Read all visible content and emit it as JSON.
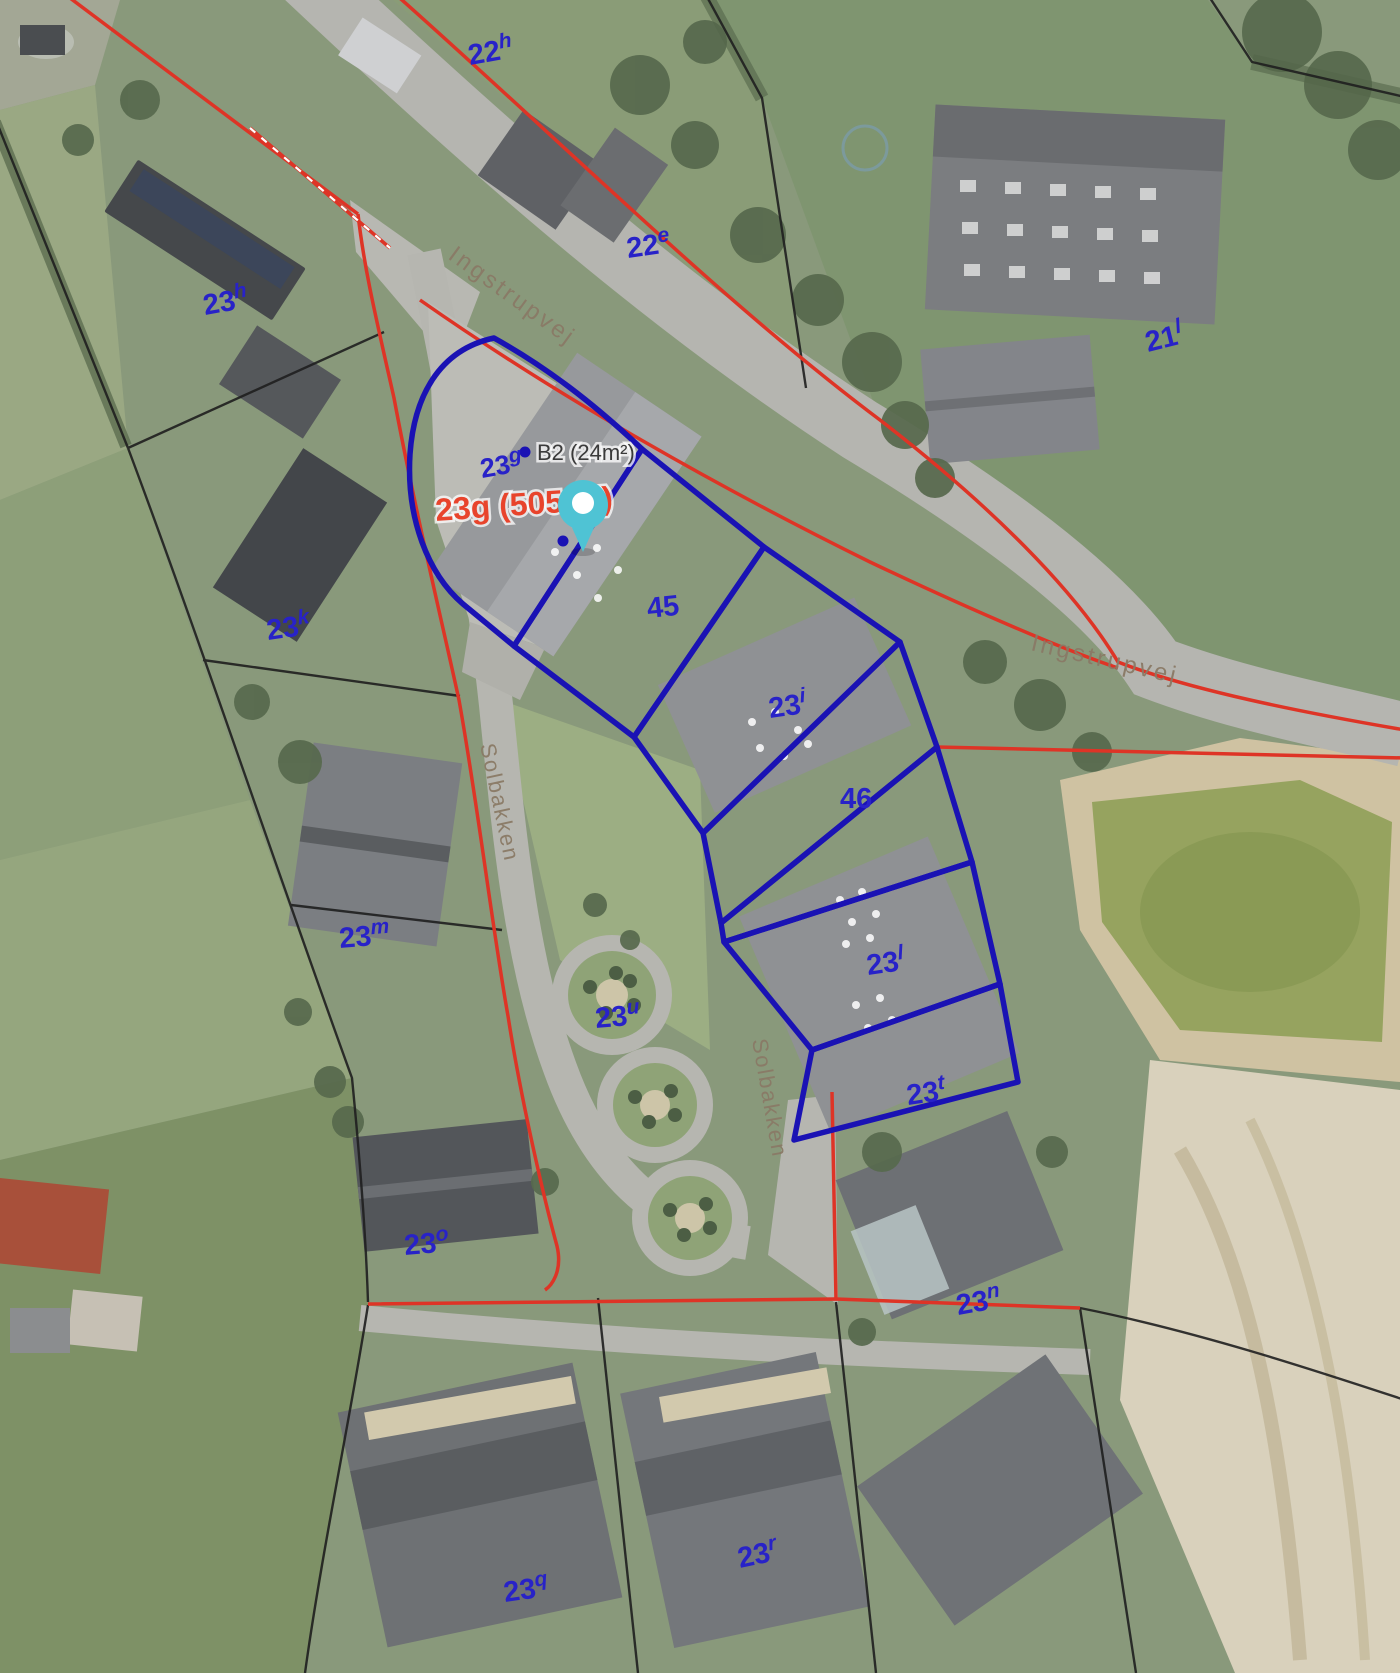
{
  "map": {
    "type": "cadastral-aerial-map",
    "parcel_labels": [
      {
        "base": "22",
        "sup": "h"
      },
      {
        "base": "22",
        "sup": "e"
      },
      {
        "base": "21",
        "sup": "l"
      },
      {
        "base": "23",
        "sup": "h"
      },
      {
        "base": "23",
        "sup": "g"
      },
      {
        "base": "23",
        "sup": "k"
      },
      {
        "base": "45",
        "sup": ""
      },
      {
        "base": "23",
        "sup": "i"
      },
      {
        "base": "46",
        "sup": ""
      },
      {
        "base": "23",
        "sup": "m"
      },
      {
        "base": "23",
        "sup": "u"
      },
      {
        "base": "23",
        "sup": "l"
      },
      {
        "base": "23",
        "sup": "t"
      },
      {
        "base": "23",
        "sup": "o"
      },
      {
        "base": "23",
        "sup": "n"
      },
      {
        "base": "23",
        "sup": "q"
      },
      {
        "base": "23",
        "sup": "r"
      }
    ],
    "road_labels": [
      {
        "text": "Ingstrupvej"
      },
      {
        "text": "Ingstrupvej"
      },
      {
        "text": "Solbakken"
      },
      {
        "text": "Solbakken"
      }
    ],
    "annotations": {
      "building_point_label": "B2 (24m²)",
      "selected_parcel_label": "23g (505m²)"
    },
    "colors": {
      "parcel_label_blue": "#2822c8",
      "highlight_boundary_blue": "#1a12b4",
      "cadastral_red": "#de3426",
      "cadastral_black": "#1f1f1f",
      "road_label_brown": "#8a7a66",
      "annotation_red": "#e8442c",
      "annotation_dark": "#3a3a3a",
      "pin_teal": "#4fc3d4"
    }
  }
}
